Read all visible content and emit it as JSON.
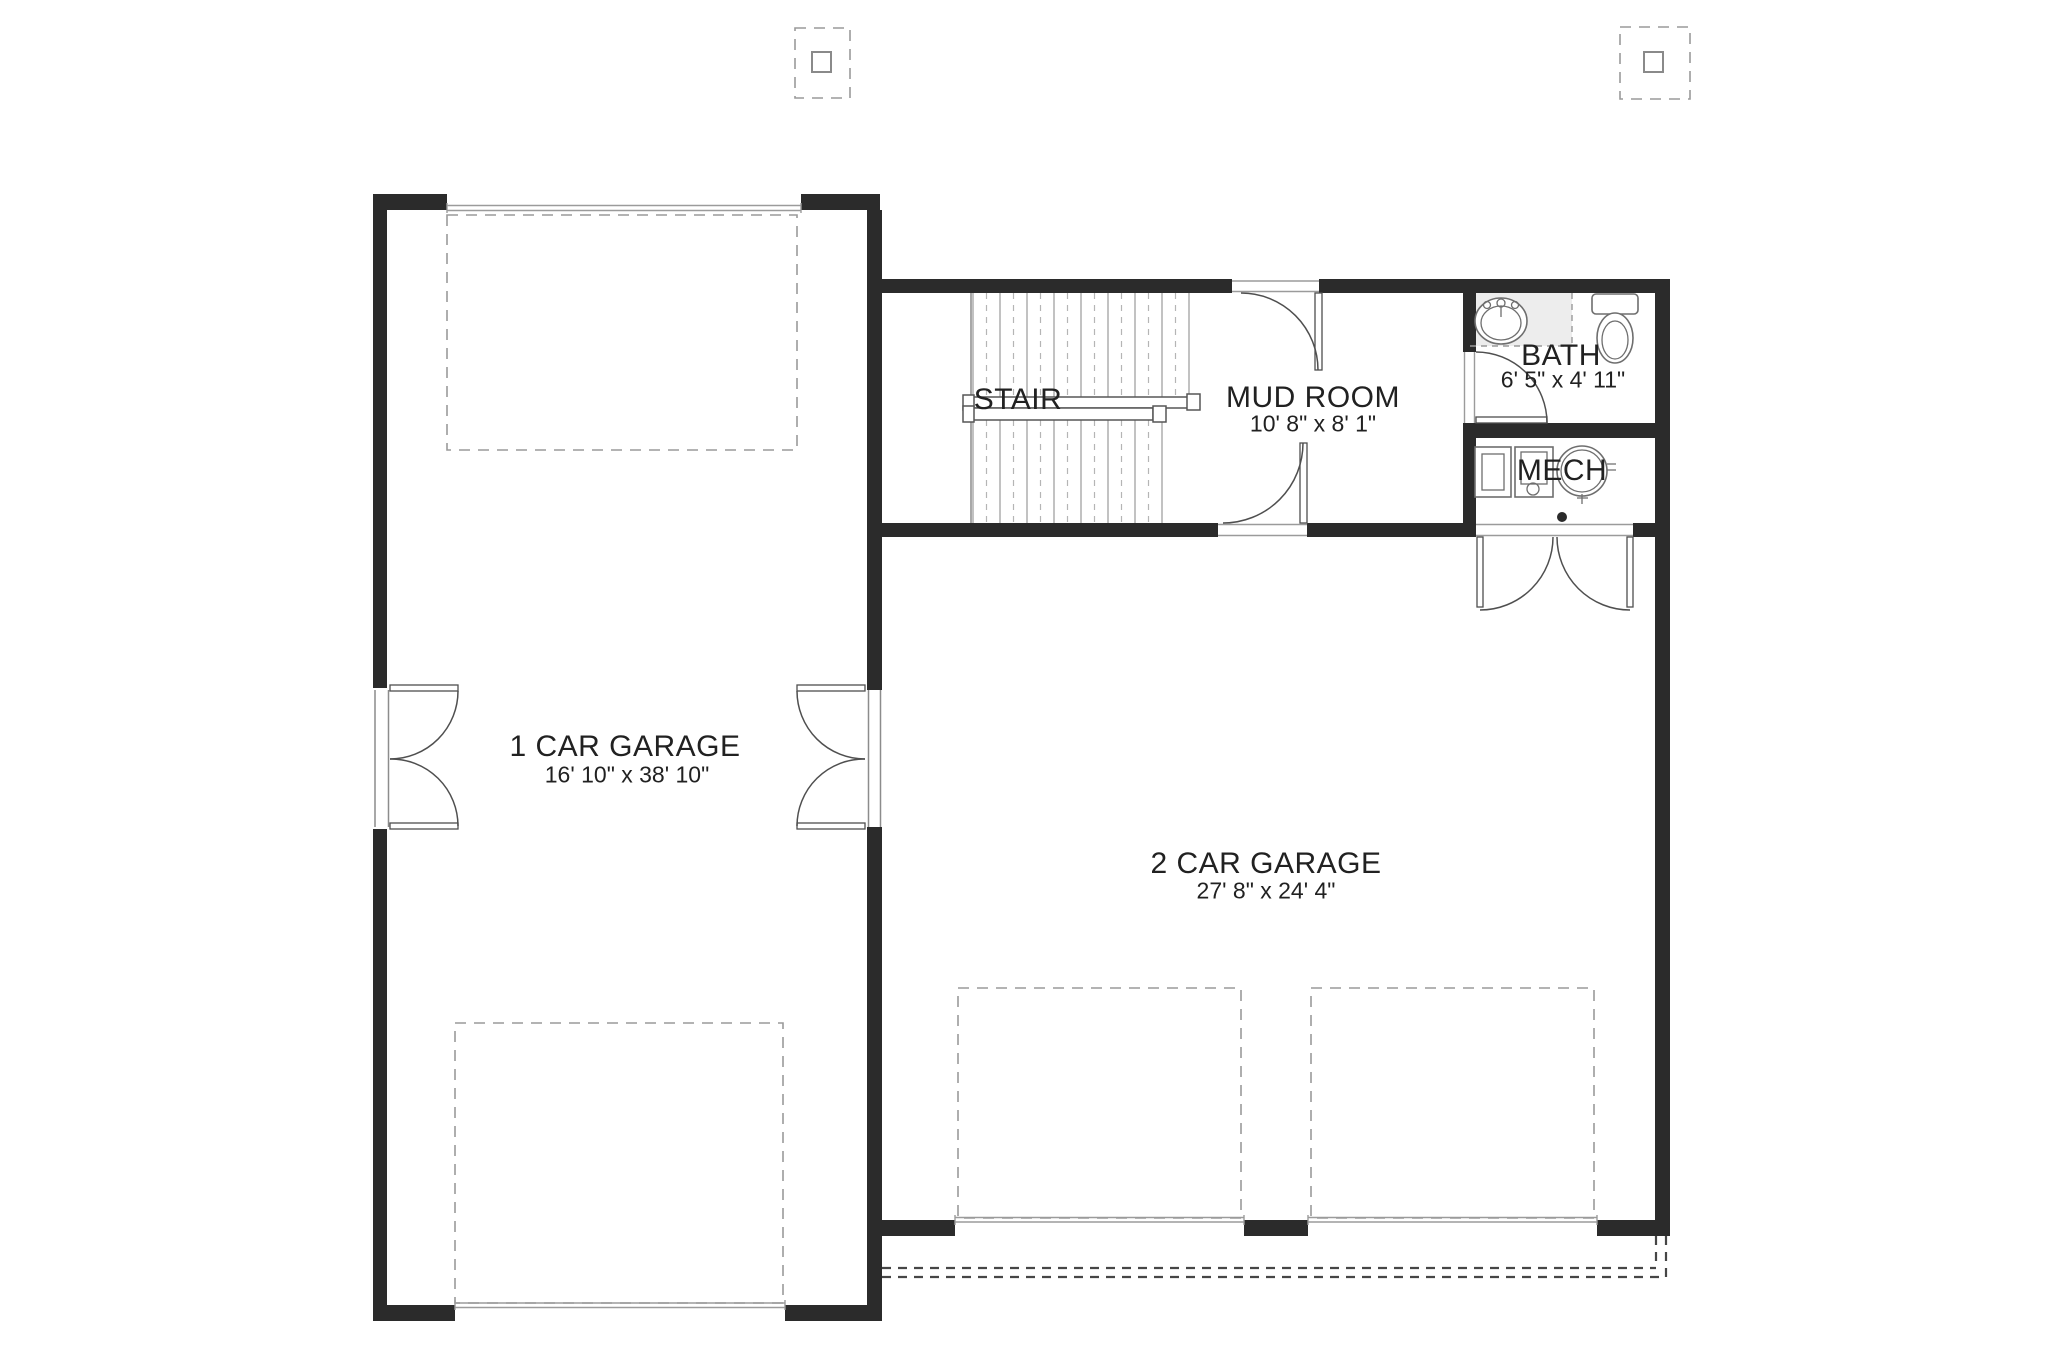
{
  "page": {
    "background": "#ffffff",
    "drawing_type": "garage-floor-plan"
  },
  "colors": {
    "wall": "#2b2b2b",
    "thin": "#8c8c8c",
    "door": "#4f4f4f",
    "dash": "#9a9a9a",
    "tread": "#a8a8a8",
    "text": "#212121",
    "counter": "#ededed",
    "apron": "#464646",
    "fixture": "#6e6e6e"
  },
  "rooms": {
    "one_car_garage": {
      "label": "1 CAR GARAGE",
      "dims": "16' 10\" x 38' 10\""
    },
    "two_car_garage": {
      "label": "2 CAR GARAGE",
      "dims": "27' 8\" x 24' 4\""
    },
    "stair": {
      "label": "STAIR"
    },
    "mud_room": {
      "label": "MUD ROOM",
      "dims": "10' 8\" x 8' 1\""
    },
    "bath": {
      "label": "BATH",
      "dims": "6' 5\" x 4' 11\""
    },
    "mech": {
      "label": "MECH"
    }
  },
  "symbols": {
    "stair": "switchback-stair-treads",
    "sink": "oval-vanity-sink",
    "toilet": "toilet-tank-and-bowl",
    "water_heater": "water-heater-circle",
    "furnace": "furnace-box",
    "utility": "utility-equipment-box",
    "floor_drain": "floor-drain-dot",
    "column_marker": "dashed-post-marker",
    "overhead_door": "dashed-overhead-garage-door",
    "driveway": "dashed-apron-lines",
    "swing_door": "quarter-arc-swing-door",
    "double_door": "butterfly-double-door"
  }
}
